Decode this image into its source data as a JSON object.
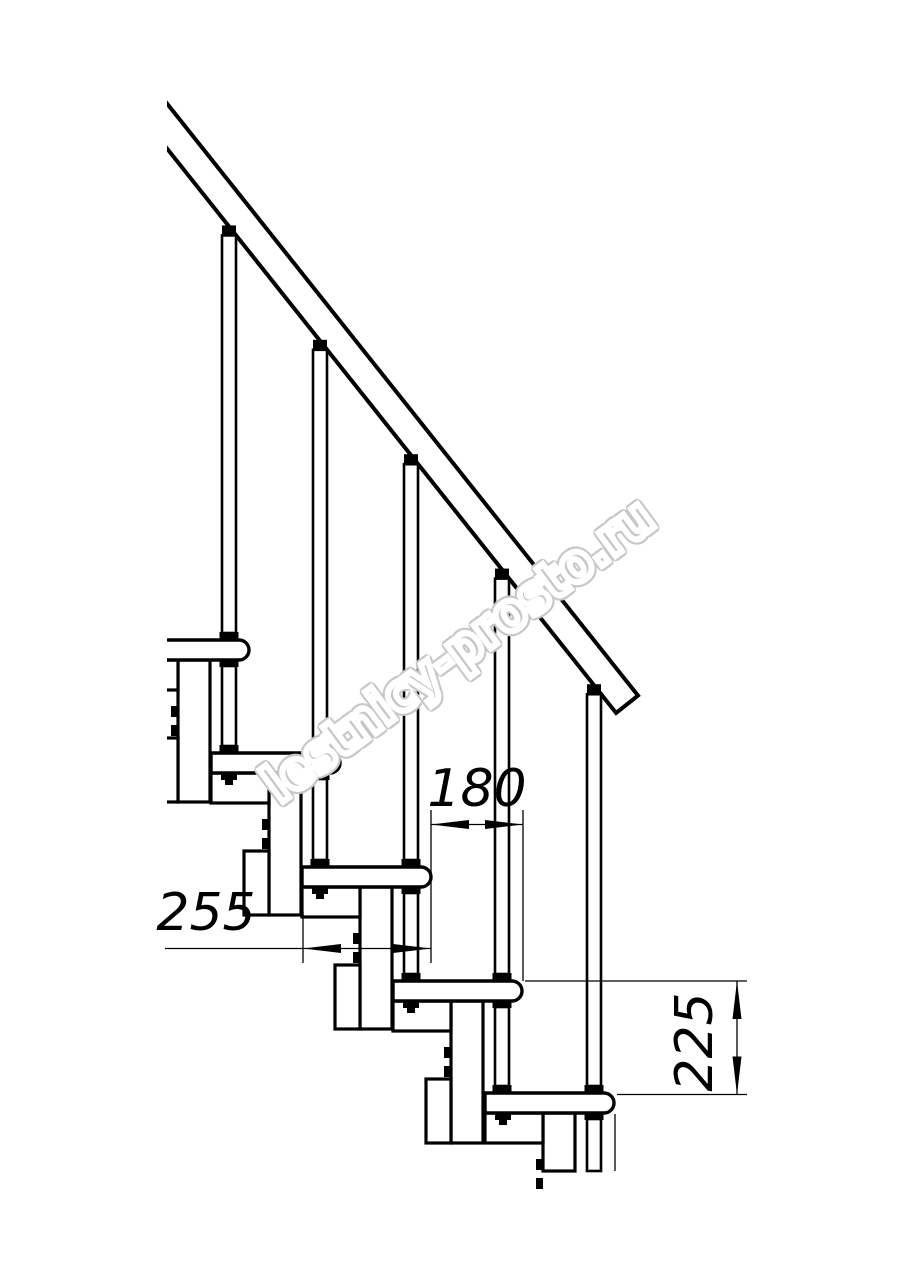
{
  "diagram": {
    "background_color": "#ffffff",
    "line_color": "#000000",
    "watermark": {
      "text": "lestnicy-prosto.ru",
      "color": "#c7c7c7"
    },
    "dimensions": {
      "step_run": "180",
      "tread_depth": "255",
      "step_rise": "225"
    },
    "counts": {
      "treads_visible": 5,
      "balusters_visible": 5
    }
  }
}
